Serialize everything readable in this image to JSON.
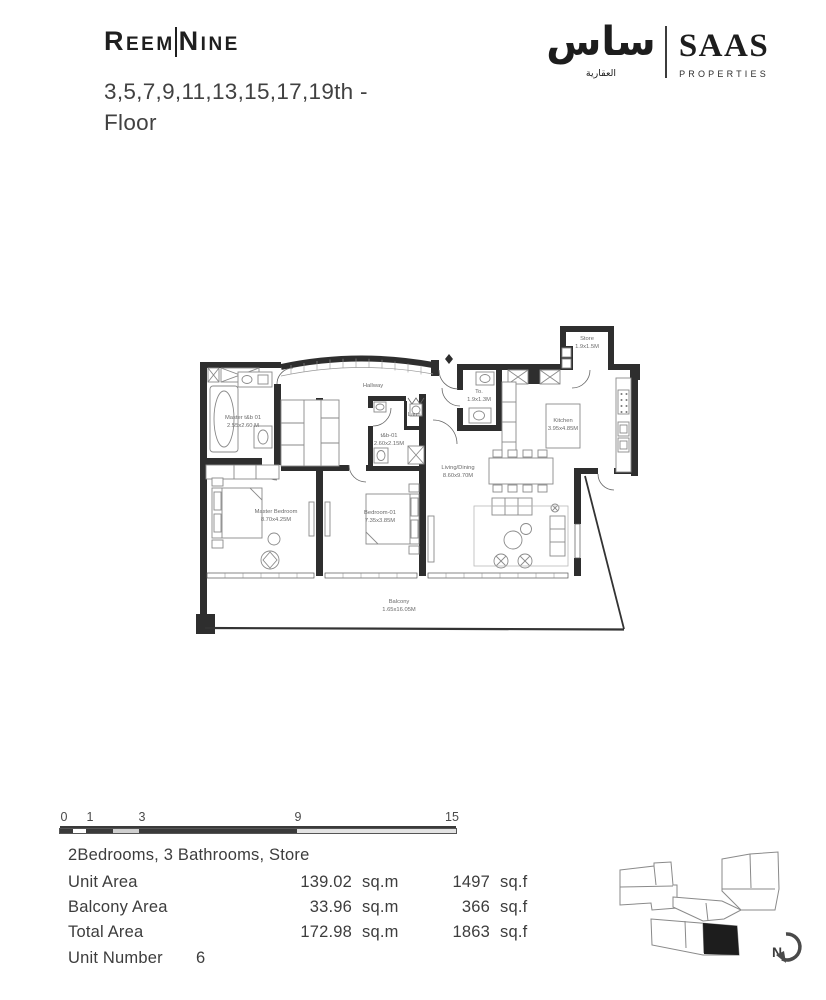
{
  "header": {
    "brand": {
      "part1": "Reem",
      "part2": "Nine"
    },
    "floor_title_line1": "3,5,7,9,11,13,15,17,19th -",
    "floor_title_line2": "Floor",
    "logo": {
      "arabic_main": "ساس",
      "arabic_sub": "العقارية",
      "latin_main": "SAAS",
      "latin_sub": "PROPERTIES"
    }
  },
  "colors": {
    "text_dark": "#3f3f3f",
    "wall_black": "#2e2e2e",
    "highlight_unit": "#1d1d1d"
  },
  "floor_plan": {
    "rooms": [
      {
        "name": "Master t&b 01",
        "dims": "2.55x2.60 M"
      },
      {
        "name": "Hallway",
        "dims": ""
      },
      {
        "name": "t&b-01",
        "dims": "2.60x2.15M"
      },
      {
        "name": "Laun.",
        "dims": ""
      },
      {
        "name": "To.",
        "dims": "1.9x1.3M"
      },
      {
        "name": "Store",
        "dims": "1.9x1.5M"
      },
      {
        "name": "Kitchen",
        "dims": "3.95x4.85M"
      },
      {
        "name": "Living/Dining",
        "dims": "8.60x9.70M"
      },
      {
        "name": "Master Bedroom",
        "dims": "8.70x4.25M"
      },
      {
        "name": "Bedroom-01",
        "dims": "7.35x3.85M"
      },
      {
        "name": "Balcony",
        "dims": "1.65x16.05M"
      }
    ]
  },
  "scale_bar": {
    "labels": [
      "0",
      "1",
      "3",
      "9",
      "15"
    ]
  },
  "unit_info": {
    "summary": "2Bedrooms, 3 Bathrooms, Store",
    "rows": [
      {
        "label": "Unit Area",
        "metric_value": "139.02",
        "metric_unit": "sq.m",
        "imperial_value": "1497",
        "imperial_unit": "sq.f"
      },
      {
        "label": "Balcony Area",
        "metric_value": "33.96",
        "metric_unit": "sq.m",
        "imperial_value": "366",
        "imperial_unit": "sq.f"
      },
      {
        "label": "Total Area",
        "metric_value": "172.98",
        "metric_unit": "sq.m",
        "imperial_value": "1863",
        "imperial_unit": "sq.f"
      }
    ],
    "unit_number_label": "Unit Number",
    "unit_number": "6"
  },
  "key_plan": {
    "north_label": "N"
  }
}
